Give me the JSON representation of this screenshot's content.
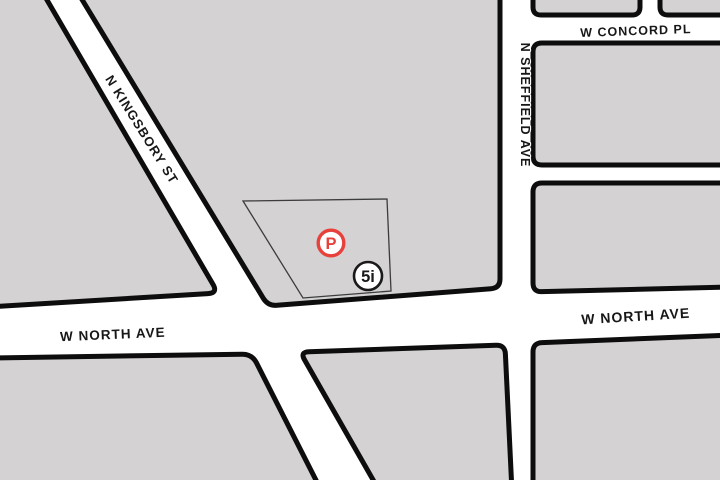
{
  "map": {
    "palette": {
      "street_color": "#ffffff",
      "block_fill": "#d4d2d3",
      "block_stroke": "#0d0d0d",
      "label_color": "#171717"
    },
    "streets": {
      "kingsbury": "N KINGSBORY ST",
      "concord": "W CONCORD PL",
      "sheffield": "N SHEFFIELD AVE",
      "north_left": "W NORTH AVE",
      "north_right": "W NORTH AVE"
    },
    "markers": {
      "parking": {
        "label": "P",
        "color": "#e8413c"
      },
      "poi": {
        "label": "5i",
        "color": "#1a1a1a"
      }
    }
  }
}
